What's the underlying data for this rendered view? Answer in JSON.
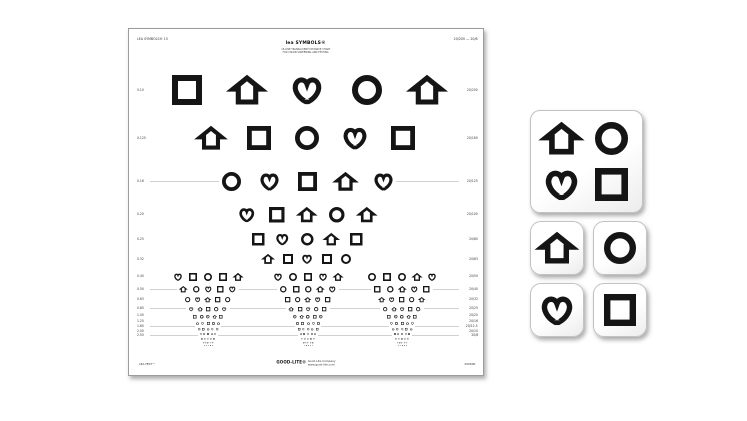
{
  "colors": {
    "symbol_ink": "#151515",
    "rule": "#b3b3b3",
    "label_ink": "#383838"
  },
  "chart": {
    "title": "lea SYMBOLS®",
    "subtitle1": "15-LINE TRANSLUCENT DISTANCE CHART",
    "subtitle2": "FOR VISION SCREENING AND TESTING",
    "corner_left": "LEA SYMBOLS® 15",
    "corner_right": "20/200 — 20/8",
    "footer": {
      "brand": "GOOD-LITE®",
      "line1": "Good-Lite Company",
      "line2": "www.good-lite.com",
      "left_mark": "LEA-TEST™",
      "catalog": "250600"
    },
    "rows": [
      {
        "y": 61,
        "size": 30,
        "spacing": 60,
        "rules": false,
        "left_label": "0.10",
        "right_label": "20/200",
        "groups": [
          [
            "square",
            "house",
            "heart",
            "circle",
            "house"
          ]
        ]
      },
      {
        "y": 109,
        "size": 24,
        "spacing": 48,
        "rules": false,
        "left_label": "0.125",
        "right_label": "20/160",
        "groups": [
          [
            "house",
            "square",
            "circle",
            "heart",
            "square"
          ]
        ]
      },
      {
        "y": 152.5,
        "size": 19,
        "spacing": 38,
        "rules": true,
        "left_label": "0.16",
        "right_label": "20/125",
        "groups": [
          [
            "circle",
            "heart",
            "square",
            "house",
            "heart"
          ]
        ]
      },
      {
        "y": 185.5,
        "size": 15.5,
        "spacing": 30,
        "rules": false,
        "left_label": "0.20",
        "right_label": "20/100",
        "groups": [
          [
            "heart",
            "square",
            "house",
            "circle",
            "house"
          ]
        ]
      },
      {
        "y": 210,
        "size": 12.5,
        "spacing": 24.5,
        "rules": false,
        "left_label": "0.25",
        "right_label": "20/80",
        "groups": [
          [
            "square",
            "heart",
            "circle",
            "house",
            "square"
          ]
        ]
      },
      {
        "y": 230,
        "size": 10,
        "spacing": 19.5,
        "rules": false,
        "left_label": "0.32",
        "right_label": "20/63",
        "groups": [
          [
            "house",
            "square",
            "heart",
            "square",
            "circle"
          ]
        ]
      },
      {
        "y": 247.5,
        "size": 8,
        "spacing": 15.2,
        "rules": false,
        "left_label": "0.40",
        "right_label": "20/50",
        "groups": [
          [
            "heart",
            "square",
            "circle",
            "square",
            "house"
          ],
          [
            "heart",
            "circle",
            "square",
            "heart",
            "house"
          ],
          [
            "circle",
            "square",
            "circle",
            "house",
            "heart"
          ]
        ]
      },
      {
        "y": 260.5,
        "size": 6.5,
        "spacing": 12.2,
        "rules": true,
        "left_label": "0.50",
        "right_label": "20/40",
        "groups": [
          [
            "house",
            "circle",
            "heart",
            "square",
            "heart"
          ],
          [
            "circle",
            "square",
            "circle",
            "house",
            "heart"
          ],
          [
            "square",
            "circle",
            "house",
            "heart",
            "square"
          ]
        ]
      },
      {
        "y": 270.5,
        "size": 5.3,
        "spacing": 10,
        "rules": false,
        "left_label": "0.63",
        "right_label": "20/32",
        "groups": [
          [
            "circle",
            "heart",
            "house",
            "square",
            "circle"
          ],
          [
            "square",
            "circle",
            "house",
            "heart",
            "square"
          ],
          [
            "house",
            "heart",
            "square",
            "circle",
            "house"
          ]
        ]
      },
      {
        "y": 279,
        "size": 4.3,
        "spacing": 8.2,
        "rules": true,
        "left_label": "0.80",
        "right_label": "20/25",
        "groups": [
          [
            "heart",
            "house",
            "square",
            "circle",
            "heart"
          ],
          [
            "house",
            "square",
            "heart",
            "circle",
            "square"
          ],
          [
            "circle",
            "house",
            "heart",
            "square",
            "circle"
          ]
        ]
      },
      {
        "y": 286.5,
        "size": 3.5,
        "spacing": 6.6,
        "rules": false,
        "left_label": "1.00",
        "right_label": "20/20",
        "groups": [
          [
            "square",
            "circle",
            "heart",
            "house",
            "square"
          ],
          [
            "heart",
            "house",
            "circle",
            "square",
            "heart"
          ],
          [
            "square",
            "heart",
            "circle",
            "house",
            "square"
          ]
        ]
      },
      {
        "y": 292.5,
        "size": 2.9,
        "spacing": 5.4,
        "rules": false,
        "left_label": "1.25",
        "right_label": "20/16",
        "groups": [
          [
            "house",
            "heart",
            "square",
            "circle",
            "house"
          ],
          [
            "circle",
            "square",
            "house",
            "heart",
            "circle"
          ],
          [
            "heart",
            "circle",
            "square",
            "house",
            "heart"
          ]
        ]
      },
      {
        "y": 297.5,
        "size": 2.4,
        "spacing": 4.4,
        "rules": true,
        "left_label": "1.60",
        "right_label": "20/12.5",
        "groups": [
          [
            "circle",
            "square",
            "house",
            "heart",
            "circle"
          ],
          [
            "square",
            "heart",
            "circle",
            "house",
            "square"
          ],
          [
            "house",
            "circle",
            "heart",
            "square",
            "house"
          ]
        ]
      },
      {
        "y": 302,
        "size": 2.0,
        "spacing": 3.6,
        "rules": false,
        "left_label": "2.00",
        "right_label": "20/10",
        "groups": [
          [
            "heart",
            "circle",
            "square",
            "house",
            "heart"
          ],
          [
            "house",
            "square",
            "heart",
            "circle",
            "house"
          ],
          [
            "square",
            "house",
            "circle",
            "heart",
            "square"
          ]
        ]
      },
      {
        "y": 306,
        "size": 1.6,
        "spacing": 3.0,
        "rules": true,
        "left_label": "2.50",
        "right_label": "20/8",
        "groups": [
          [
            "square",
            "house",
            "heart",
            "circle",
            "square"
          ],
          [
            "heart",
            "circle",
            "house",
            "square",
            "heart"
          ],
          [
            "circle",
            "heart",
            "square",
            "house",
            "circle"
          ]
        ]
      },
      {
        "y": 309.5,
        "size": 1.3,
        "spacing": 2.4,
        "rules": false,
        "left_label": "",
        "right_label": "",
        "groups": [
          [
            "circle",
            "house",
            "square",
            "heart",
            "circle"
          ],
          [
            "square",
            "heart",
            "circle",
            "house",
            "square"
          ],
          [
            "heart",
            "square",
            "house",
            "circle",
            "heart"
          ]
        ]
      },
      {
        "y": 312.5,
        "size": 1.0,
        "spacing": 2.0,
        "rules": false,
        "left_label": "",
        "right_label": "",
        "groups": [
          [
            "house",
            "circle",
            "heart",
            "square",
            "house"
          ],
          [
            "heart",
            "square",
            "circle",
            "house",
            "heart"
          ],
          [
            "circle",
            "heart",
            "square",
            "house",
            "circle"
          ]
        ]
      }
    ]
  },
  "cards": {
    "large_symbols": [
      "house",
      "circle",
      "heart",
      "square"
    ],
    "small": [
      "house",
      "circle",
      "heart",
      "square"
    ]
  }
}
